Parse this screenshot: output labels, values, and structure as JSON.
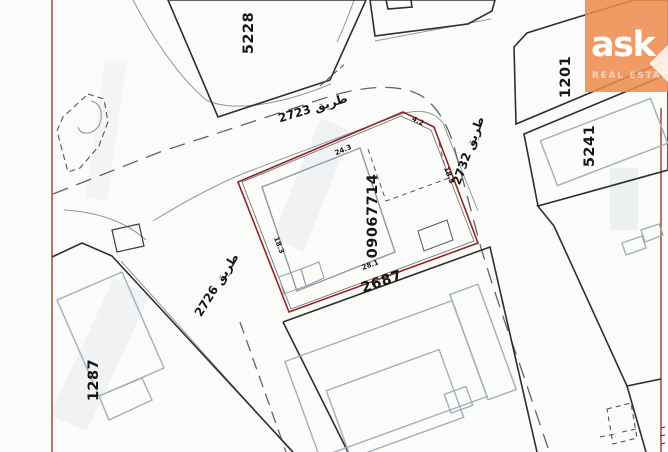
{
  "logo": {
    "brand": "ask",
    "tagline": "REAL ESTATE"
  },
  "map": {
    "target_plot": {
      "id": "09067714",
      "dimensions": {
        "top": "24.3",
        "corner": "4.2",
        "right": "18.5",
        "left": "18.3",
        "bottom": "28.1"
      }
    },
    "street_number": "2687",
    "plots": {
      "p5228": "5228",
      "p1201": "1201",
      "p5241": "5241",
      "p1287": "1287"
    },
    "roads": {
      "r2723": "طريق 2723",
      "r2732": "طريق 2732",
      "r2726": "طريق 2726"
    },
    "colors": {
      "target_outline": "#8e2723",
      "map_border": "#a5523d",
      "parcel_line": "#2e2e2e",
      "building_line": "#9fb0ba",
      "logo_orange": "#ee8b4f"
    }
  }
}
